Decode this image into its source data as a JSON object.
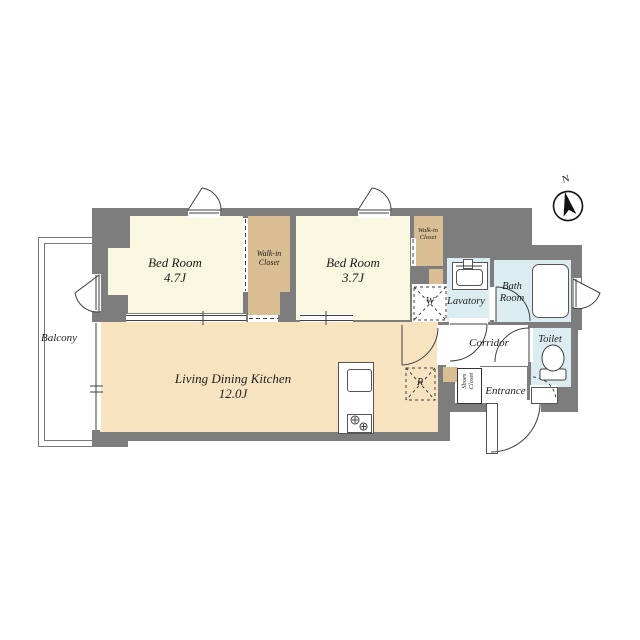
{
  "plan": {
    "type": "apartment-floor-plan",
    "compass": {
      "north": "N"
    },
    "rooms": {
      "balcony": {
        "name": "Balcony"
      },
      "bedroom1": {
        "name": "Bed Room",
        "size": "4.7J"
      },
      "bedroom2": {
        "name": "Bed Room",
        "size": "3.7J"
      },
      "wic1": {
        "name": "Walk-in Closet"
      },
      "wic2": {
        "name": "Walk-in Closet"
      },
      "ldk": {
        "name": "Living Dining Kitchen",
        "size": "12.0J"
      },
      "lavatory": {
        "name": "Lavatory"
      },
      "bathroom": {
        "name": "Bath Room"
      },
      "toilet": {
        "name": "Toilet"
      },
      "corridor": {
        "name": "Corridor"
      },
      "entrance": {
        "name": "Entrance"
      },
      "shoes_closet": {
        "name": "Shoes Closet"
      }
    },
    "fixtures": {
      "washing_machine": "W",
      "refrigerator": "R"
    },
    "colors": {
      "wall": "#7d7d7d",
      "bedroom_floor": "#faf7e1",
      "closet_floor": "#d8be92",
      "ldk_floor": "#f8e3c1",
      "wet_area_floor": "#dcedf2",
      "line": "#3f3f3f"
    }
  }
}
